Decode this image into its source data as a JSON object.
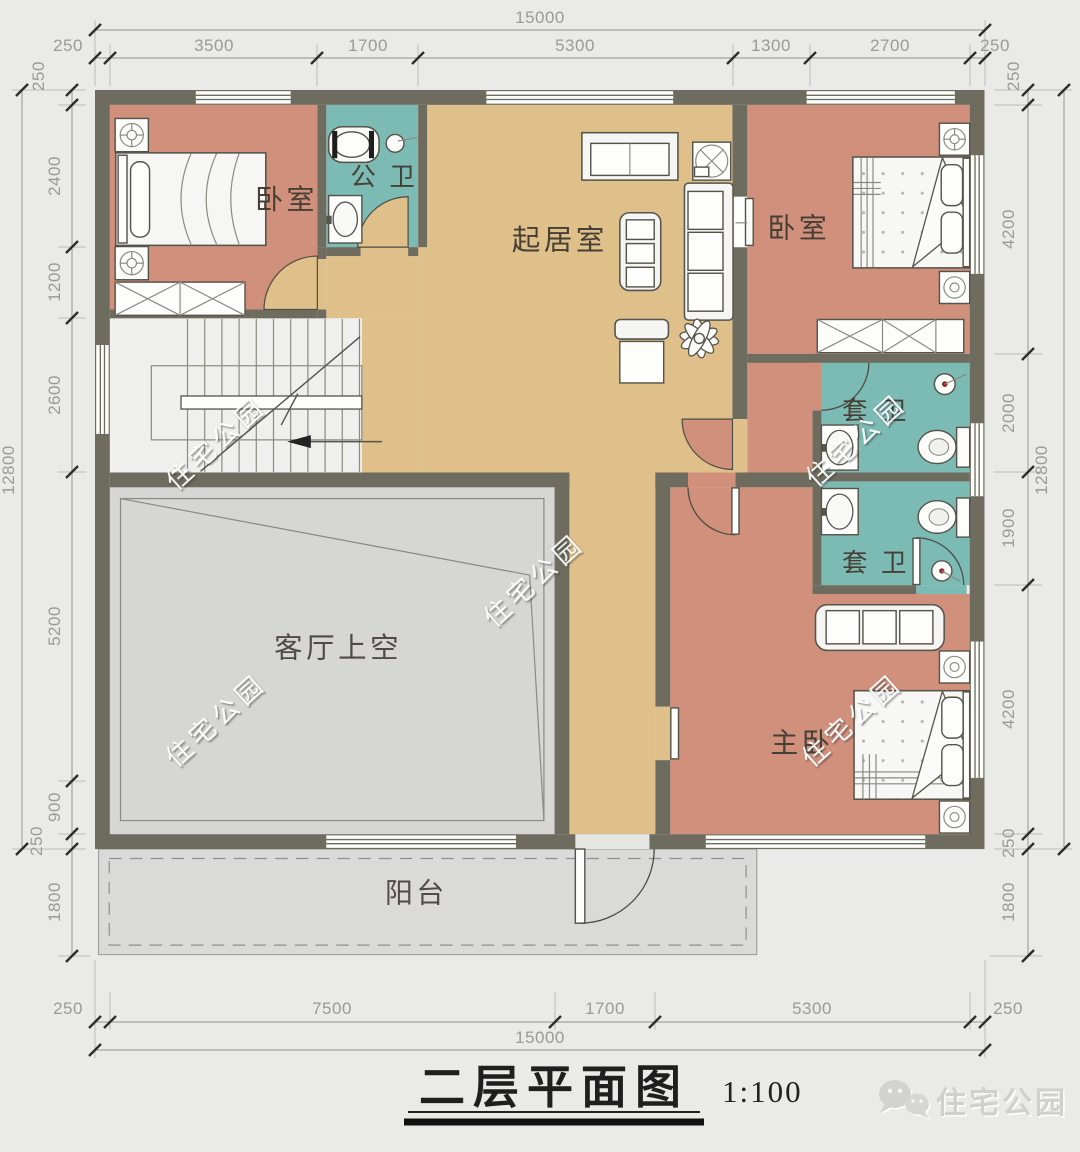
{
  "title": {
    "text": "二层平面图",
    "scale": "1:100"
  },
  "brand": {
    "name": "住宅公园",
    "icon": "wechat-icon"
  },
  "watermark": {
    "text": "住宅公园"
  },
  "rooms": {
    "bedroom_nw": "卧室",
    "public_bath": "公 卫",
    "living_room": "起居室",
    "bedroom_ne": "卧室",
    "ensuite_upper": "套 卫",
    "ensuite_lower": "套 卫",
    "void_above_living": "客厅上空",
    "master_bedroom": "主卧",
    "balcony": "阳台"
  },
  "dims": {
    "top_total": "15000",
    "bottom_total": "15000",
    "left_total": "12800",
    "right_total": "12800",
    "top_segments": [
      "250",
      "3500",
      "1700",
      "5300",
      "1300",
      "2700",
      "250"
    ],
    "bottom_segments": [
      "250",
      "7500",
      "1700",
      "5300",
      "250"
    ],
    "left_segments": [
      "250",
      "2400",
      "1200",
      "2600",
      "5200",
      "900",
      "250",
      "1800"
    ],
    "right_segments": [
      "250",
      "4200",
      "2000",
      "1900",
      "4200",
      "250",
      "1800"
    ]
  },
  "colors": {
    "wall": "#6d6c5e",
    "bedroom": "#d0907c",
    "bath": "#7cbab4",
    "living": "#dfc08a",
    "void": "#d6d6d4",
    "stairs": "#efefed",
    "balcony": "#dadad8",
    "background": "#eaeae8",
    "dimension": "#9a9a9a"
  }
}
